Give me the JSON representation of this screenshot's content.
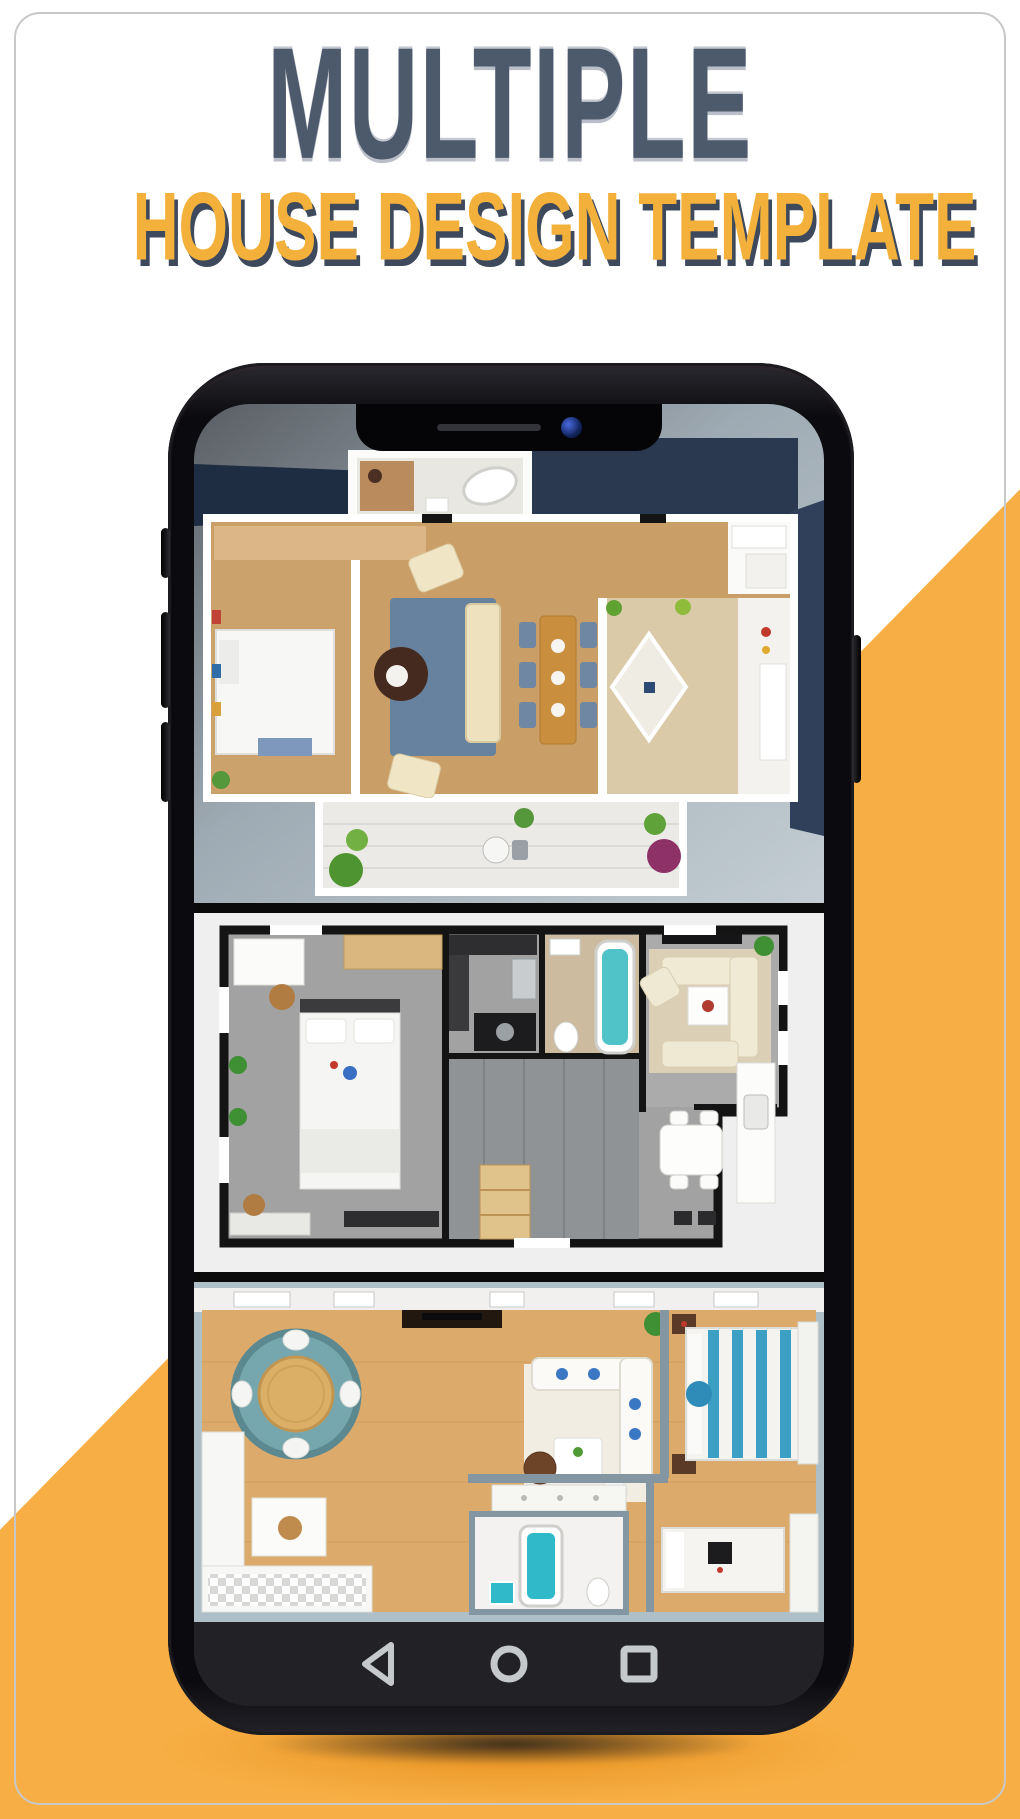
{
  "theme": {
    "page-bg": "#ffffff",
    "accent": "#F7AF45",
    "accent-deep": "#EE9B22",
    "card-border": "#C8C8C8",
    "title-color": "#4D5A6B",
    "subtitle-color": "#F3B13C",
    "subtitle-shadow": "#3E4A5C",
    "phone-body": "#0B0B0F",
    "navbar-bg": "#222226",
    "nav-icon": "#C6C9CC"
  },
  "header": {
    "title": "MULTIPLE",
    "subtitle": "HOUSE DESIGN TEMPLATE"
  },
  "phone": {
    "notch": {
      "speaker": "speaker-slot",
      "camera": "front-camera"
    },
    "side_buttons": [
      "mute",
      "volume-up",
      "volume-down",
      "power"
    ],
    "navbar": {
      "icons": [
        {
          "name": "back",
          "shape": "triangle-outline"
        },
        {
          "name": "home",
          "shape": "circle-outline"
        },
        {
          "name": "recents",
          "shape": "square-outline"
        }
      ]
    }
  },
  "floor_plans": [
    {
      "id": "plan-1",
      "style": "3d-top-view",
      "background": "#A6B1B9",
      "floor": "#C99F67",
      "accents": [
        "#67829E",
        "#C98F3F",
        "#2B3950"
      ]
    },
    {
      "id": "plan-2",
      "style": "3d-top-view",
      "background": "#EFEFEF",
      "floor": "#A2A2A3",
      "accents": [
        "#4FC3C7",
        "#DBCFB6",
        "#141414"
      ]
    },
    {
      "id": "plan-3",
      "style": "3d-top-view",
      "background": "#DCAB6C",
      "floor": "#DCAB6C",
      "accents": [
        "#76A7AE",
        "#2FB9C9",
        "#3BA0C4"
      ]
    }
  ]
}
